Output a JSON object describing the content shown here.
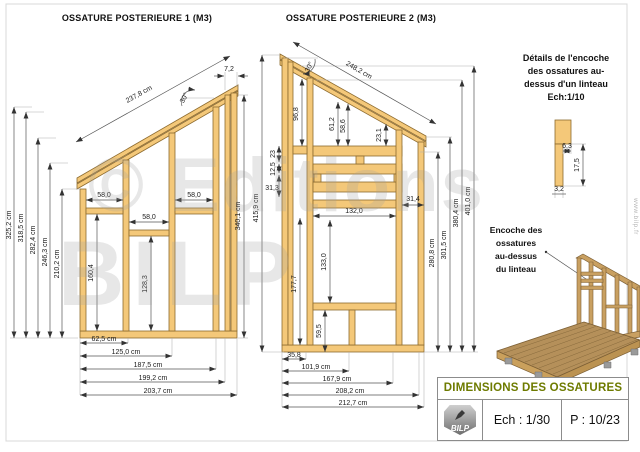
{
  "d1": {
    "title": "OSSATURE POSTERIEURE 1 (M3)",
    "slope": "237,8 cm",
    "angle": "30°",
    "gap": "7,2",
    "left": [
      "325,2 cm",
      "318,5 cm",
      "282,4 cm",
      "246,3 cm",
      "210,2 cm"
    ],
    "right": "340,1 cm",
    "w1": "58,0",
    "w2": "58,0",
    "w3": "58,0",
    "v1": "160,4",
    "v2": "128,3",
    "bottom": [
      "62,5 cm",
      "125,0 cm",
      "187,5 cm",
      "199,2 cm",
      "203,7 cm"
    ]
  },
  "d2": {
    "title": "OSSATURE POSTERIEURE 2 (M3)",
    "slope": "248,2 cm",
    "angle": "30°",
    "left": "415,9 cm",
    "v_top": "96,8",
    "v_mid": "177,7",
    "v_a": "61,2",
    "v_b": "58,6",
    "v_c": "23,1",
    "s1": "23",
    "s2": "12,5",
    "s3": "31,3",
    "win_w": "132,0",
    "win_h": "133,0",
    "under": "59,5",
    "side": "31,4",
    "right": [
      "280,8 cm",
      "301,5 cm",
      "380,4 cm",
      "401,0 cm"
    ],
    "bottom": [
      "35,8",
      "101,9 cm",
      "167,9 cm",
      "208,2 cm",
      "212,7 cm"
    ]
  },
  "detail": {
    "lines": [
      "Détails de l'encoche",
      "des ossatures au-",
      "dessus d'un linteau",
      "Ech:1/10"
    ],
    "d1": "6,3",
    "d2": "17,5",
    "d3": "3,2"
  },
  "callout": {
    "lines": [
      "Encoche des",
      "ossatures",
      "au-dessus",
      "du linteau"
    ]
  },
  "block": {
    "title": "DIMENSIONS DES OSSATURES",
    "logo": "BILP",
    "scale": "Ech : 1/30",
    "page": "P : 10/23"
  },
  "watermark": {
    "l1": "© Editions",
    "l2": "BILP"
  },
  "site": "www.bilp.fr"
}
